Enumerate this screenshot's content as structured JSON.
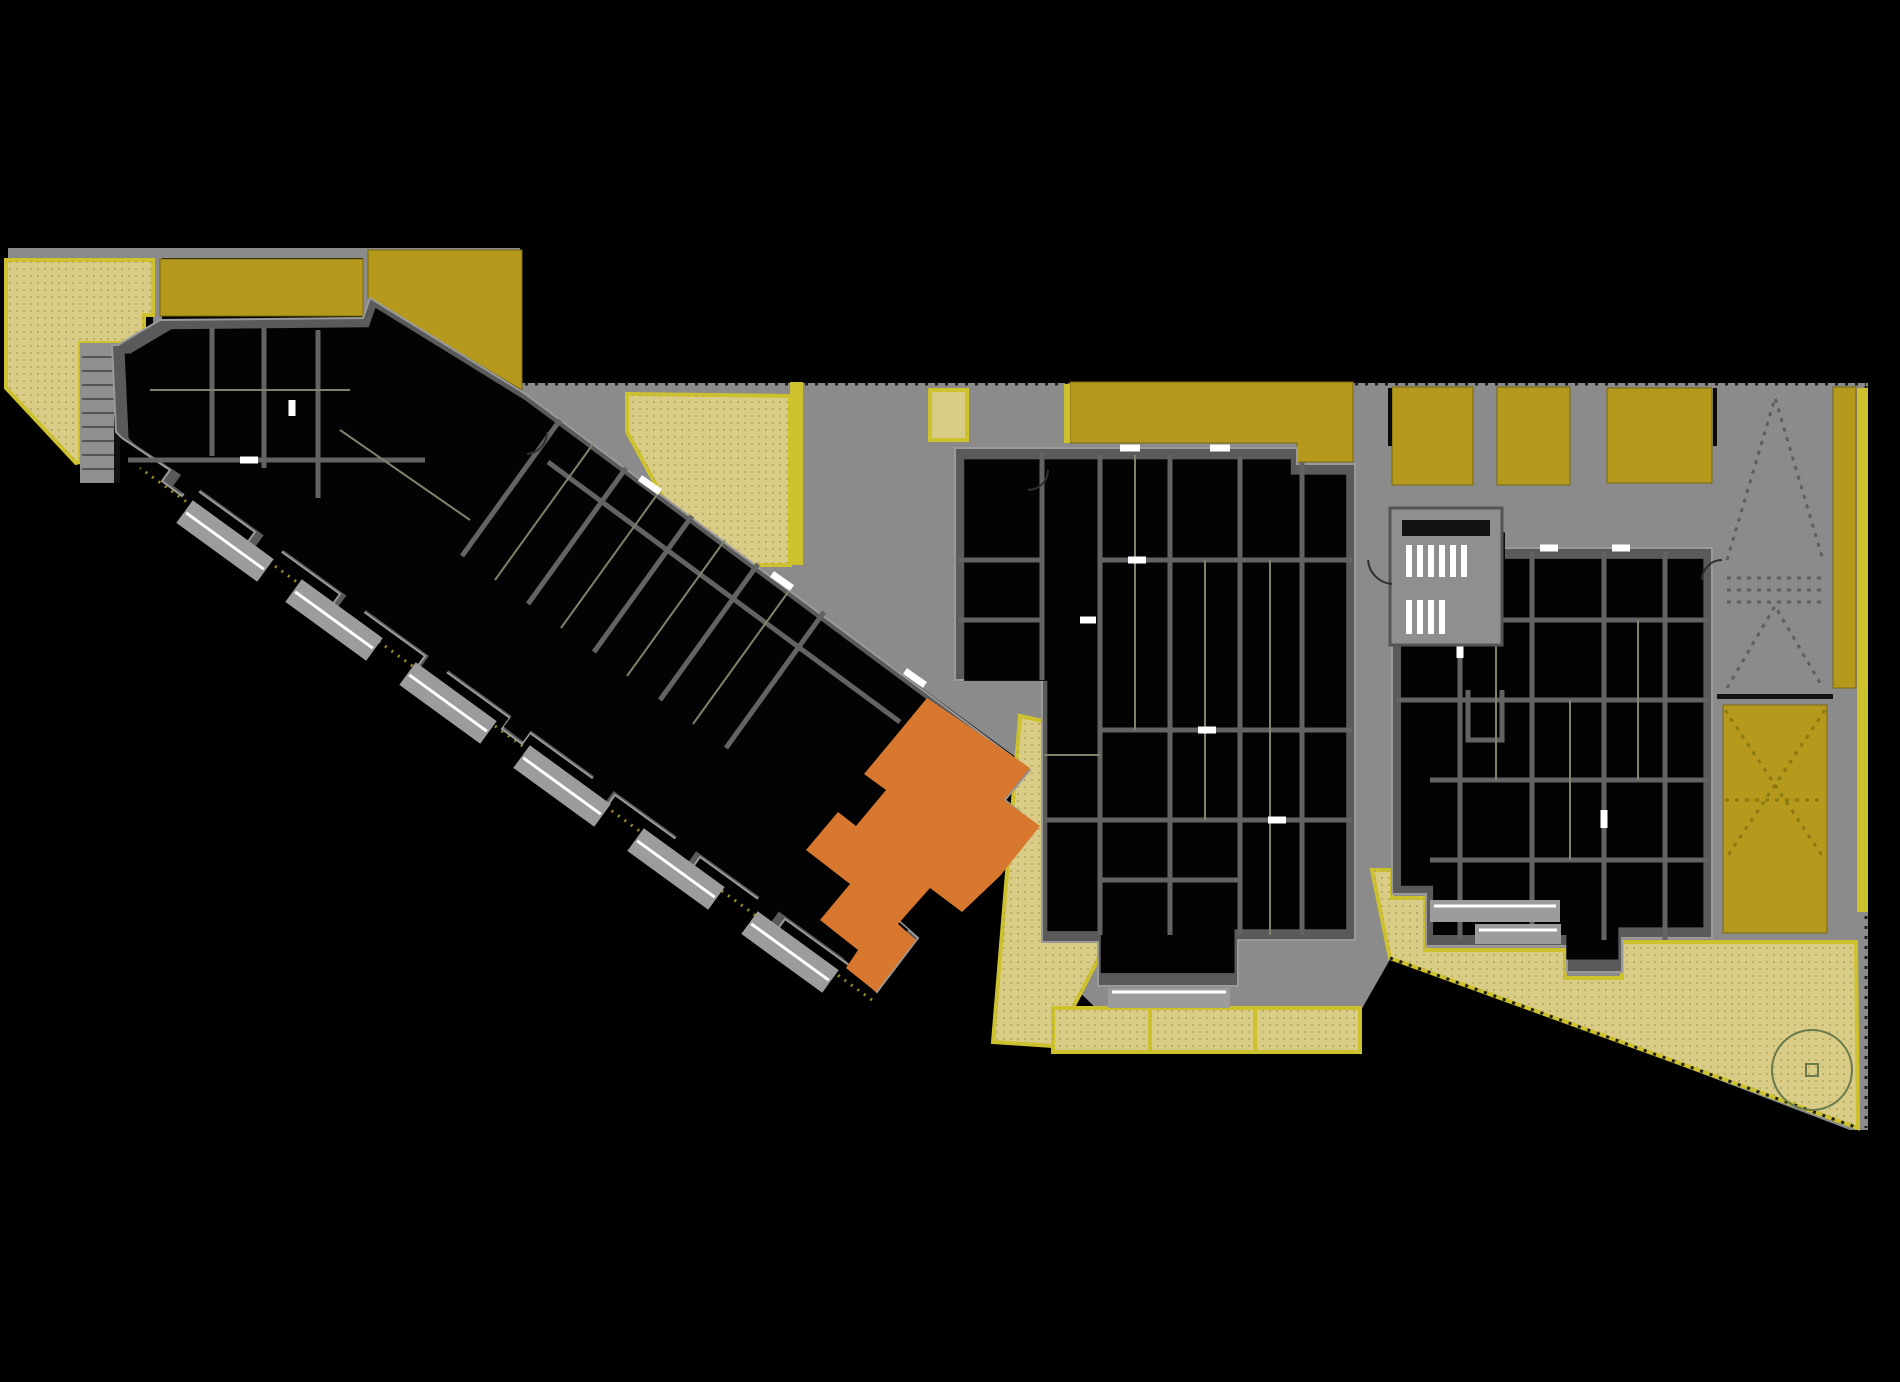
{
  "plan": {
    "palette": {
      "background": "#000000",
      "walkway_gray": "#8b8b8b",
      "wall_gray": "#5a5a5a",
      "room_fill": "#030303",
      "terrace_gold": "#b5991d",
      "garden_khaki": "#d8cc87",
      "edge_yellow": "#cdc22e",
      "selected_unit_orange": "#d8782e",
      "balcony_gray": "#9c9c9c",
      "stair_core_gray": "#8f8f8f",
      "partition_olive": "#7a856c",
      "detail_white": "#ffffff",
      "tree_olive": "#6b7a4a"
    },
    "regions": {
      "left_wing": "left-residential-wing",
      "middle_building": "central-residential-block",
      "right_building": "east-residential-block",
      "selected_unit": "highlighted-apartment-unit",
      "gardens": "private-garden-terraces",
      "roof_terraces": "roof-terraces",
      "walkways": "shared-walkway-plaza",
      "ramp": "parking-ramp",
      "skylight": "ramp-skylight",
      "tree": "garden-tree"
    }
  }
}
